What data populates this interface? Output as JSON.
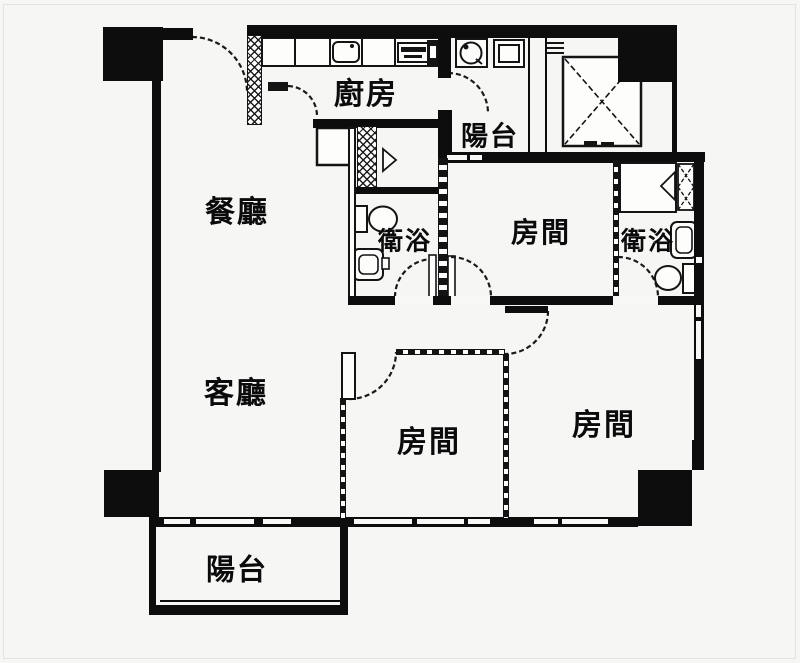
{
  "plan_type": "apartment floor plan",
  "colors": {
    "wall": "#0d0d0d",
    "background": "#f6f6f4",
    "line": "#141414"
  },
  "rooms": [
    {
      "id": "kitchen",
      "label": "廚房"
    },
    {
      "id": "balcony_top",
      "label": "陽台"
    },
    {
      "id": "dining_room",
      "label": "餐廳"
    },
    {
      "id": "bathroom_center",
      "label": "衛浴"
    },
    {
      "id": "bedroom_top_right",
      "label": "房間"
    },
    {
      "id": "bathroom_right",
      "label": "衛浴"
    },
    {
      "id": "living_room",
      "label": "客廳"
    },
    {
      "id": "bedroom_bottom_middle",
      "label": "房間"
    },
    {
      "id": "bedroom_bottom_right",
      "label": "房間"
    },
    {
      "id": "balcony_bottom",
      "label": "陽台"
    }
  ],
  "fixtures": [
    "kitchen-counter",
    "kitchen-sink",
    "stove",
    "refrigerator",
    "washing-machine",
    "water-heater",
    "elevator-shaft",
    "pipe-duct",
    "toilet",
    "washbasin",
    "shower",
    "closet-door",
    "door-swing-arcs",
    "windows",
    "structural-columns"
  ]
}
